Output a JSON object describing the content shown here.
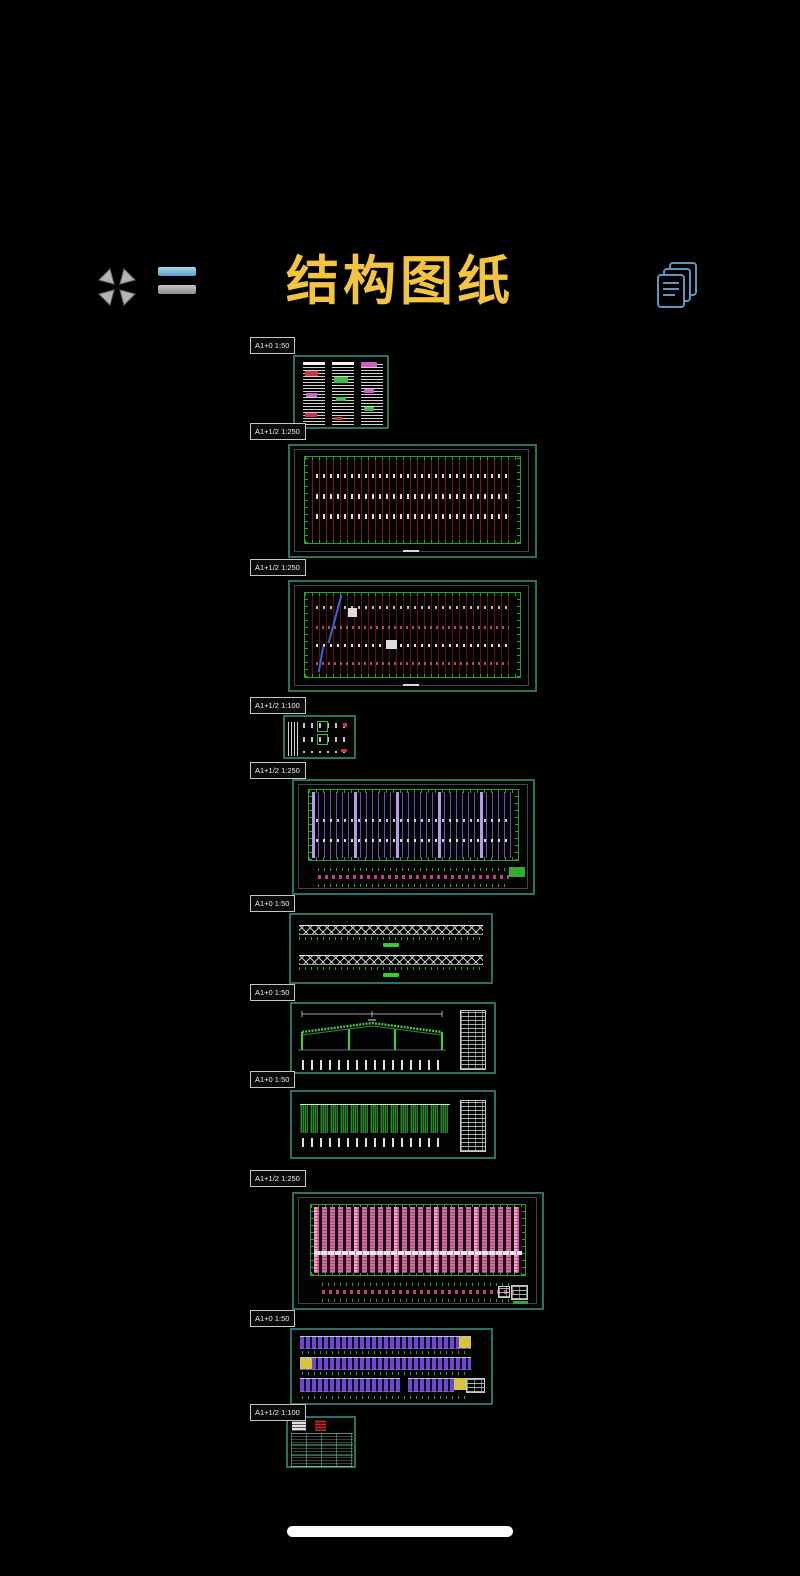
{
  "header": {
    "title": "结构图纸",
    "icons": [
      {
        "name": "collapse-icon"
      },
      {
        "name": "menu-lines-icon"
      },
      {
        "name": "pages-icon"
      }
    ]
  },
  "sheets": [
    {
      "tag": "A1+0 1:50"
    },
    {
      "tag": "A1+1/2 1:250"
    },
    {
      "tag": "A1+1/2 1:250"
    },
    {
      "tag": "A1+1/2 1:100"
    },
    {
      "tag": "A1+1/2 1:250"
    },
    {
      "tag": "A1+0 1:50"
    },
    {
      "tag": "A1+0 1:50"
    },
    {
      "tag": "A1+0 1:50"
    },
    {
      "tag": "A1+1/2 1:250"
    },
    {
      "tag": "A1+0 1:50"
    },
    {
      "tag": "A1+1/2 1:100"
    }
  ],
  "colors": {
    "title": "#F2C441",
    "thumbnail_border": "#2D6E66",
    "tag_border": "#C6C6C6",
    "collapse_icon": "#B5B5B5",
    "menu_icon_top": "#7AB6DC",
    "menu_icon_bottom": "#A6A6A6",
    "pages_icon": "#5D97C0",
    "home_indicator": "#FFFFFF"
  }
}
